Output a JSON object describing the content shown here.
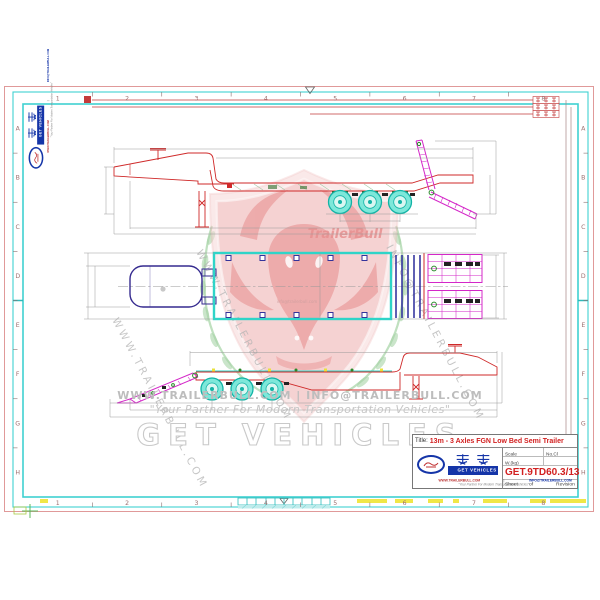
{
  "sheet": {
    "description": "Engineering drawing sheet of a lowbed semi trailer, three views with zone-bordered frame"
  },
  "zones": {
    "columns": [
      "1",
      "2",
      "3",
      "4",
      "5",
      "6",
      "7",
      "8"
    ],
    "rows": [
      "A",
      "B",
      "C",
      "D",
      "E",
      "F",
      "G",
      "H"
    ]
  },
  "brand": {
    "chinese_name": "概特",
    "name": "GET VEHICLES",
    "website": "WWW.TRAILERBULL.COM",
    "email": "INFO@TRAILERBULL.COM",
    "email_small": "info@trailerbull.com",
    "contact_separator": "|",
    "contact_line": "WWW.TRAILERBULL.COM  |  INFO@TRAILERBULL.COM",
    "tagline": "\"Your Partner For Modern Transportation Vehicles\"",
    "watermark_name": "TrailerBull"
  },
  "title_block": {
    "title_label": "Title:",
    "title": "13m - 3 Axles FGN Low Bed Semi Trailer",
    "scale_label": "Scale",
    "no_label": "No.Cl",
    "weight_label": "W.(kg)",
    "drawing_no": "GET.9TD60.3/13",
    "sheet_label": "Sheet",
    "of_label": "of",
    "revision_label": "Revision"
  },
  "redline_labels": [
    "整车长",
    "轴距",
    "后悬长"
  ],
  "colors": {
    "frame_cyan": "#3fd1d1",
    "paper_edge_pink": "#e09999",
    "outline_red": "#cf2a2a",
    "ramp_magenta": "#d428c8",
    "wheel_cyan": "#7de8da",
    "wheel_rim": "#12b3a6",
    "plan_blue": "#2a2a9a",
    "gooseneck_blue": "#352a8f",
    "brand_blue": "#1535a8",
    "title_red": "#d22020",
    "check_yellow": "#f0e63e",
    "detail_green": "#2a8a2a",
    "watermark_pink": "#f1bcbc",
    "laurel_green": "#a8d4a8",
    "dim_gray": "#9a9a9a"
  }
}
